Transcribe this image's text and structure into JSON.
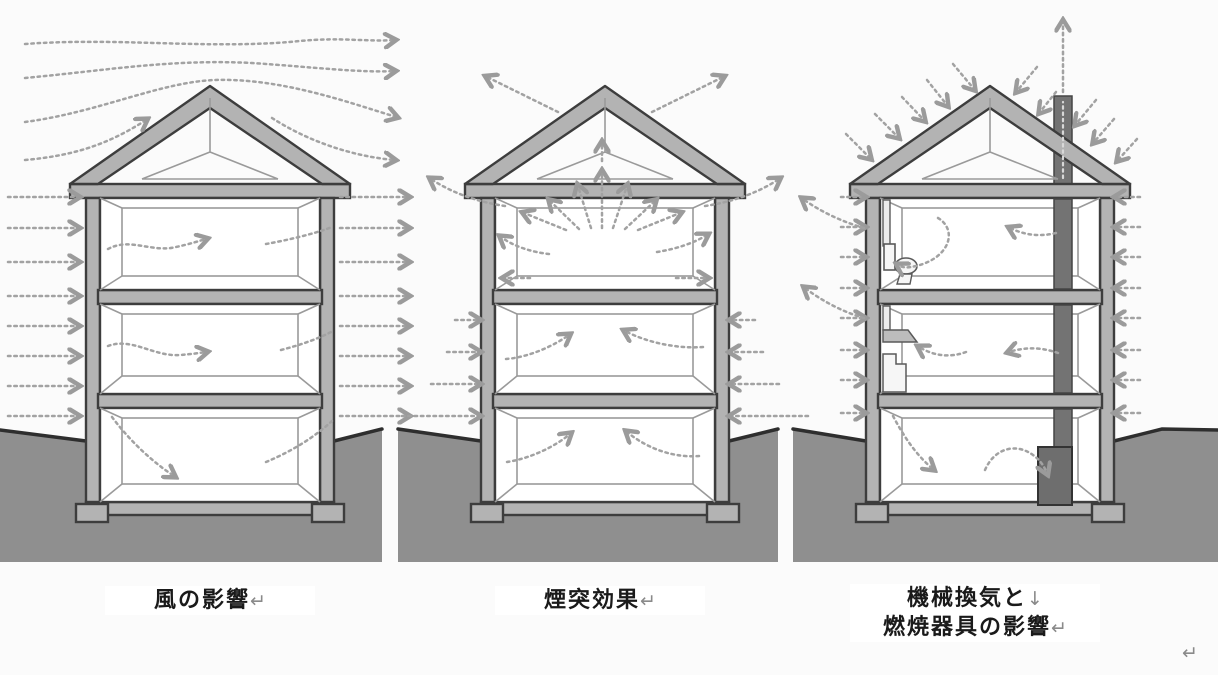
{
  "captions": [
    {
      "lines": [
        "風の影響"
      ],
      "return_mark": "↵"
    },
    {
      "lines": [
        "煙突効果"
      ],
      "return_mark": "↵"
    },
    {
      "lines": [
        "機械換気と",
        "燃焼器具の影響"
      ],
      "line_break_mark": "↓",
      "return_mark": "↵"
    }
  ],
  "trailing_mark": "↵",
  "palette": {
    "background": "#fbfbfb",
    "house_gray": "#b3b3b3",
    "outline_dark": "#3d3d3d",
    "interior_line": "#9a9a9a",
    "ground_gray": "#8f8f8f",
    "ground_edge": "#2e2e2e",
    "arrow_gray": "#a2a2a2",
    "chimney_gray": "#737373",
    "appliance_gray": "#6e6e6e",
    "caption_text": "#1a1a1a",
    "mark_gray": "#8a8a8a"
  }
}
